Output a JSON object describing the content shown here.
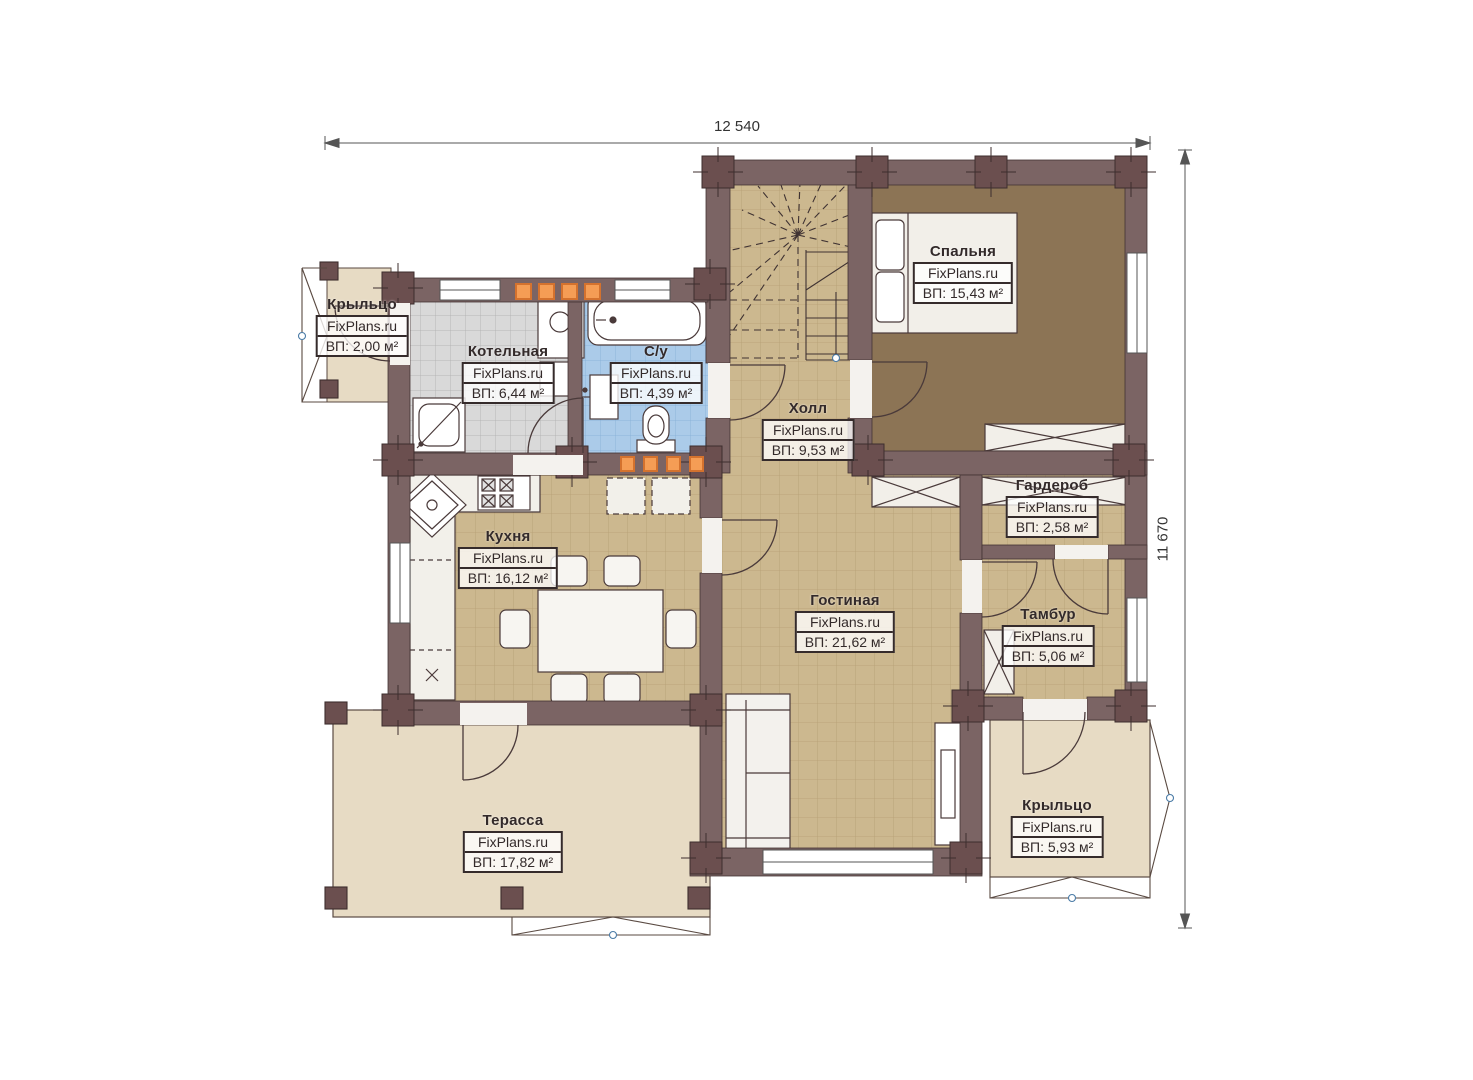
{
  "watermark": "FixPlans.ru",
  "dimensions": {
    "width": "12 540",
    "height": "11 670"
  },
  "rooms": [
    {
      "key": "porch_top",
      "name": "Крыльцо",
      "area": "ВП: 2,00 м²"
    },
    {
      "key": "boiler",
      "name": "Котельная",
      "area": "ВП: 6,44 м²"
    },
    {
      "key": "bathroom",
      "name": "С/у",
      "area": "ВП: 4,39 м²"
    },
    {
      "key": "hall",
      "name": "Холл",
      "area": "ВП: 9,53 м²"
    },
    {
      "key": "bedroom",
      "name": "Спальня",
      "area": "ВП: 15,43 м²"
    },
    {
      "key": "wardrobe",
      "name": "Гардероб",
      "area": "ВП: 2,58 м²"
    },
    {
      "key": "kitchen",
      "name": "Кухня",
      "area": "ВП: 16,12 м²"
    },
    {
      "key": "living",
      "name": "Гостиная",
      "area": "ВП: 21,62 м²"
    },
    {
      "key": "vestibule",
      "name": "Тамбур",
      "area": "ВП: 5,06 м²"
    },
    {
      "key": "terrace",
      "name": "Терасса",
      "area": "ВП: 17,82 м²"
    },
    {
      "key": "porch_bottom",
      "name": "Крыльцо",
      "area": "ВП: 5,93 м²"
    }
  ],
  "colors": {
    "wall": "#7b6464",
    "column": "#6b4f4f",
    "floor_main": "#ccb88f",
    "floor_bedroom": "#8c7455",
    "floor_bathroom": "#abcbe9",
    "floor_boiler": "#d9d9d9",
    "floor_outdoor": "#e7dbc4",
    "vent": "#e8833a",
    "line": "#4a3a3a"
  }
}
